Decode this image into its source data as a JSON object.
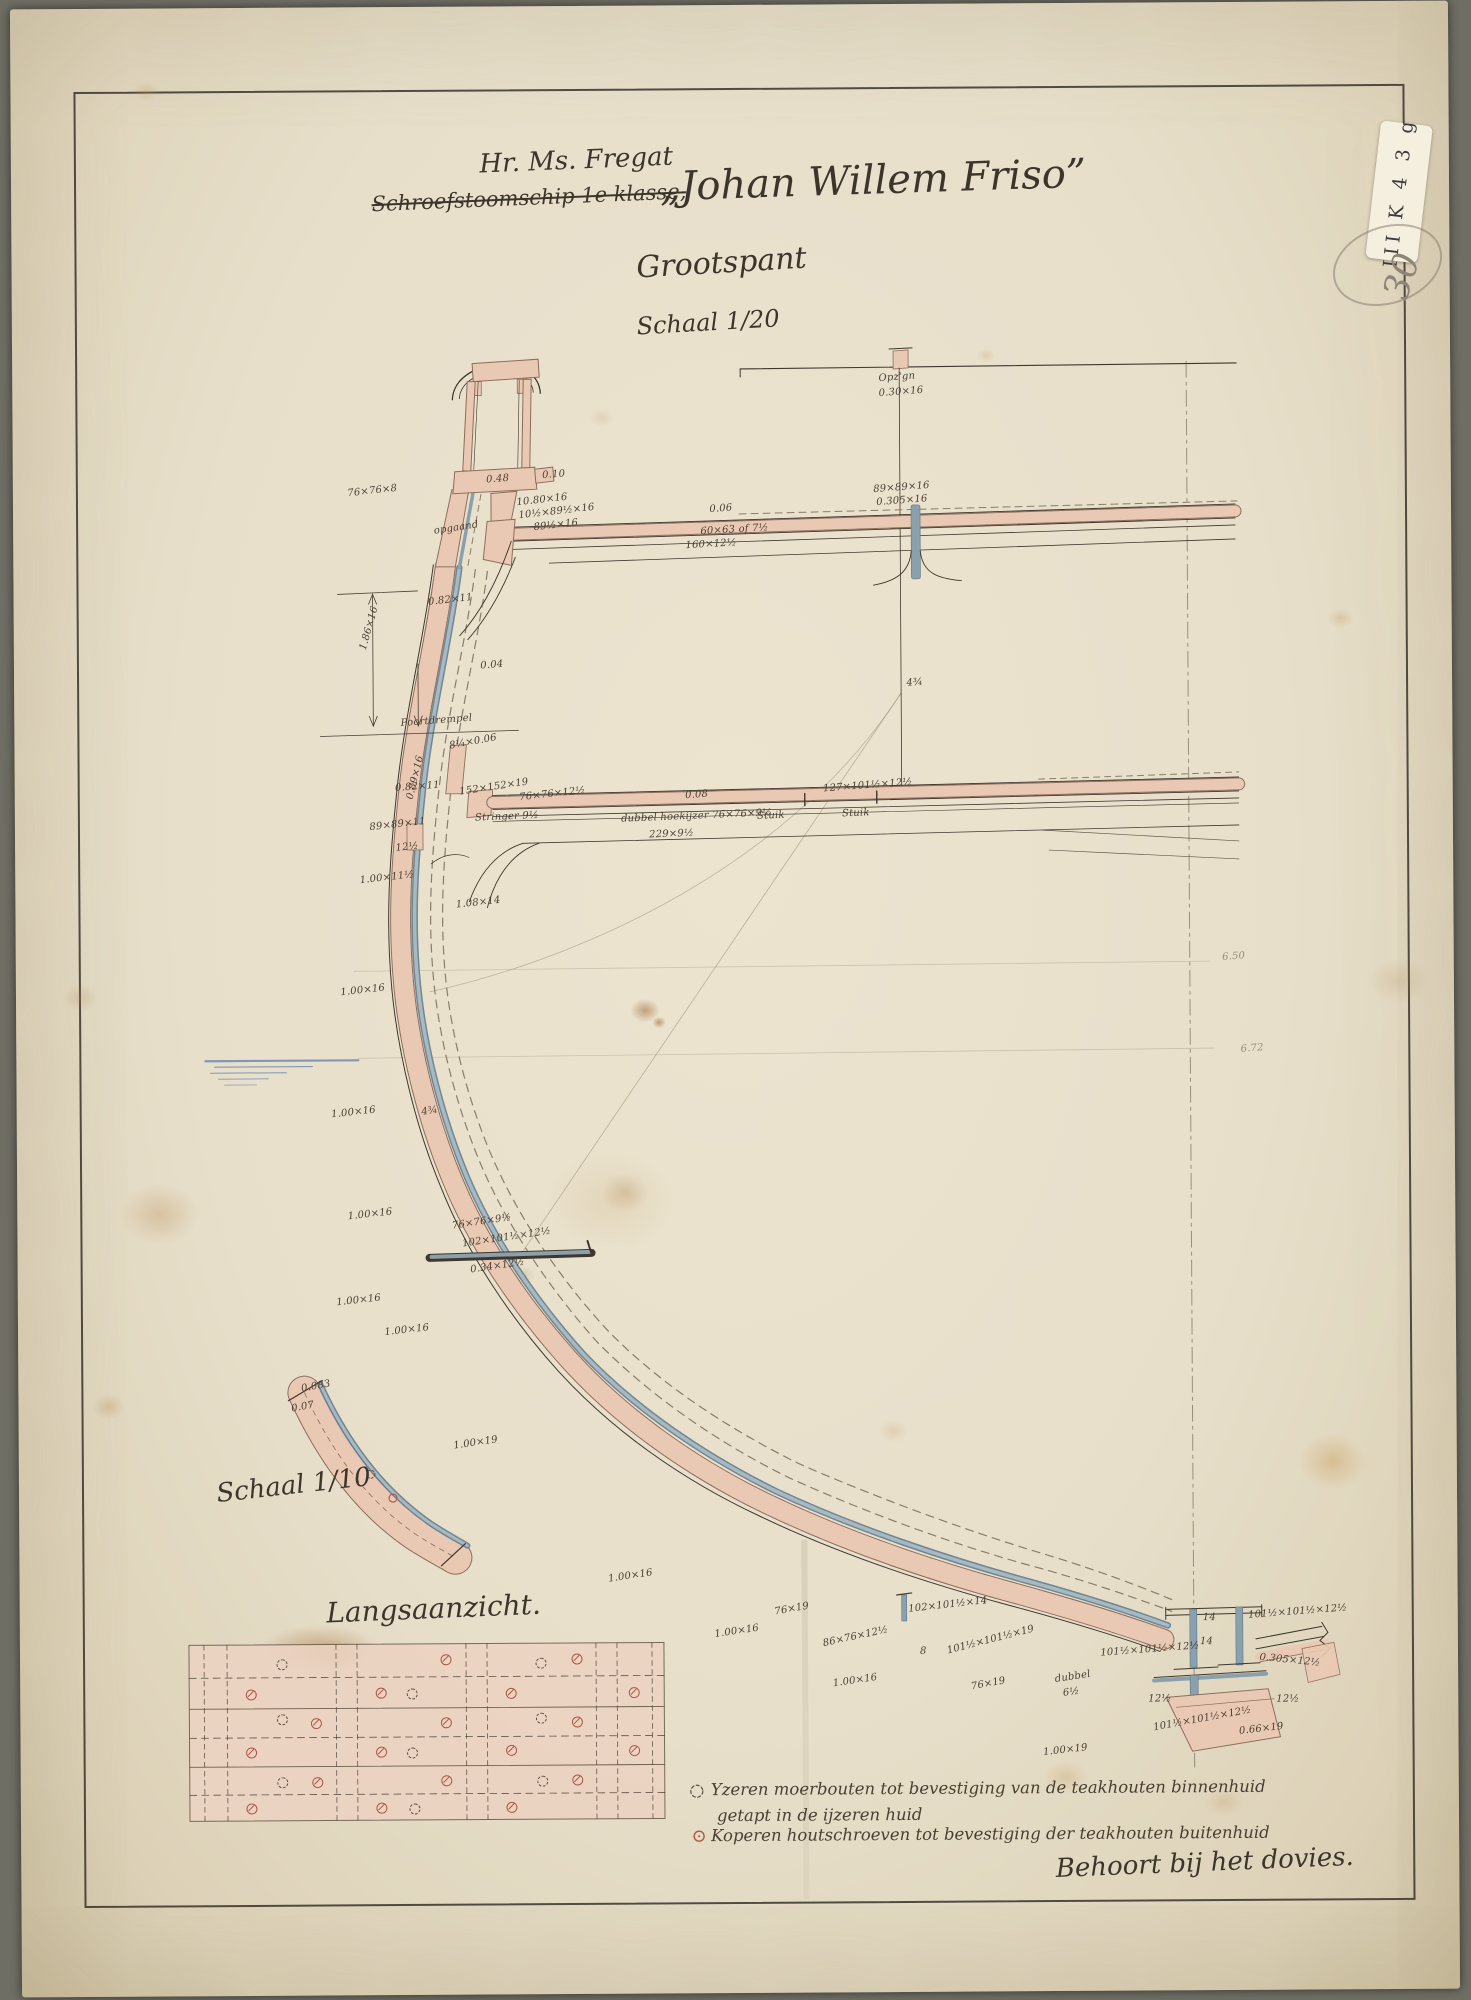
{
  "title": {
    "line1": "Hr. Ms. Fregat",
    "struck": "Schroefstoomschip 1e klasse,",
    "ship_name": "„Johan Willem Friso”",
    "subtitle": "Grootspant",
    "scale_main": "Schaal 1/20"
  },
  "labels": {
    "scale_detail": "Schaal 1/10",
    "side_view": "Langsaanzicht.",
    "note_bottom": "Behoort bij het dovies."
  },
  "stamp": {
    "text": "III K 4 3 g",
    "pencil_number": "30"
  },
  "legend": {
    "items": [
      {
        "symbol": "iron-bolt-symbol",
        "text": "Yzeren moerbouten tot bevestiging van de teakhouten binnenhuid",
        "text2": "getapt in de ijzeren huid"
      },
      {
        "symbol": "copper-screw-symbol",
        "text": "Koperen houtschroeven tot bevestiging der teakhouten buitenhuid",
        "text2": ""
      }
    ]
  },
  "colors": {
    "paper": "#e7dfca",
    "ink": "#3f372c",
    "wood_pink": "#eac9b4",
    "iron_blue": "#8aa0ad",
    "copper_red": "#b05548",
    "pencil": "#8d8578",
    "waterline_blue": "#7f98b5"
  },
  "annotations": [
    {
      "t": "0.48",
      "x": 489,
      "y": 473,
      "r": -4
    },
    {
      "t": "0.10",
      "x": 545,
      "y": 469,
      "r": -4
    },
    {
      "t": "76×76×8",
      "x": 350,
      "y": 486,
      "r": -6
    },
    {
      "t": "10.80×16",
      "x": 519,
      "y": 496,
      "r": -6
    },
    {
      "t": "10½×89½×16",
      "x": 521,
      "y": 509,
      "r": -6
    },
    {
      "t": "89½×16",
      "x": 536,
      "y": 521,
      "r": -6
    },
    {
      "t": "opgaand",
      "x": 436,
      "y": 524,
      "r": -8
    },
    {
      "t": "Opz'gn",
      "x": 882,
      "y": 374,
      "r": -4
    },
    {
      "t": "0.30×16",
      "x": 882,
      "y": 389,
      "r": -4
    },
    {
      "t": "89×89×16",
      "x": 876,
      "y": 485,
      "r": -4
    },
    {
      "t": "0.305×16",
      "x": 879,
      "y": 498,
      "r": -4
    },
    {
      "t": "0.06",
      "x": 712,
      "y": 504,
      "r": -4
    },
    {
      "t": "60×63 of 7½",
      "x": 703,
      "y": 526,
      "r": -3
    },
    {
      "t": "160×12½",
      "x": 688,
      "y": 540,
      "r": -3
    },
    {
      "t": "0.82×11",
      "x": 430,
      "y": 595,
      "r": -6
    },
    {
      "t": "1.86×16",
      "x": 360,
      "y": 646,
      "r": -74
    },
    {
      "t": "0.04",
      "x": 482,
      "y": 659,
      "r": -4
    },
    {
      "t": "Poortdrempel",
      "x": 402,
      "y": 716,
      "r": -4
    },
    {
      "t": "8¼×0.06",
      "x": 450,
      "y": 739,
      "r": -10
    },
    {
      "t": "0.89×16",
      "x": 406,
      "y": 796,
      "r": -76
    },
    {
      "t": "0.82×11",
      "x": 396,
      "y": 781,
      "r": -4
    },
    {
      "t": "89×89×11",
      "x": 370,
      "y": 820,
      "r": -6
    },
    {
      "t": "152×152×19",
      "x": 460,
      "y": 785,
      "r": -8
    },
    {
      "t": "76×76×12½",
      "x": 520,
      "y": 791,
      "r": -6
    },
    {
      "t": "0.08",
      "x": 686,
      "y": 790,
      "r": -4
    },
    {
      "t": "127×101½×12½",
      "x": 824,
      "y": 784,
      "r": -4
    },
    {
      "t": "Stringer 9½",
      "x": 476,
      "y": 811,
      "r": -2
    },
    {
      "t": "dubbel hoekijzer 76×76×9½",
      "x": 622,
      "y": 813,
      "r": -2
    },
    {
      "t": "Stuik",
      "x": 758,
      "y": 811,
      "r": -2
    },
    {
      "t": "Stuik",
      "x": 843,
      "y": 809,
      "r": -2
    },
    {
      "t": "229×9½",
      "x": 650,
      "y": 829,
      "r": -2
    },
    {
      "t": "12½",
      "x": 396,
      "y": 841,
      "r": -6
    },
    {
      "t": "4¾",
      "x": 908,
      "y": 679,
      "r": -4
    },
    {
      "t": "1.00×11½",
      "x": 360,
      "y": 873,
      "r": -6
    },
    {
      "t": "1.08×14",
      "x": 456,
      "y": 898,
      "r": -6
    },
    {
      "t": "1.00×16",
      "x": 340,
      "y": 985,
      "r": -6
    },
    {
      "t": "1.00×16",
      "x": 330,
      "y": 1107,
      "r": -6
    },
    {
      "t": "4¾",
      "x": 420,
      "y": 1105,
      "r": -8
    },
    {
      "t": "1.00×16",
      "x": 346,
      "y": 1209,
      "r": -6
    },
    {
      "t": "76×76×9½",
      "x": 450,
      "y": 1219,
      "r": -8
    },
    {
      "t": "102×101½×12½",
      "x": 460,
      "y": 1237,
      "r": -8
    },
    {
      "t": "0.34×12½",
      "x": 468,
      "y": 1263,
      "r": -8
    },
    {
      "t": "1.00×16",
      "x": 334,
      "y": 1295,
      "r": -6
    },
    {
      "t": "1.00×16",
      "x": 382,
      "y": 1325,
      "r": -6
    },
    {
      "t": "1.00×19",
      "x": 450,
      "y": 1439,
      "r": -8
    },
    {
      "t": "1.00×16",
      "x": 604,
      "y": 1573,
      "r": -8
    },
    {
      "t": "76×19",
      "x": 770,
      "y": 1607,
      "r": -10
    },
    {
      "t": "1.00×16",
      "x": 710,
      "y": 1629,
      "r": -8
    },
    {
      "t": "86×76×12½",
      "x": 818,
      "y": 1639,
      "r": -12
    },
    {
      "t": "8",
      "x": 916,
      "y": 1647,
      "r": 0
    },
    {
      "t": "102×101½×14",
      "x": 904,
      "y": 1605,
      "r": -6
    },
    {
      "t": "101½×101½×19",
      "x": 942,
      "y": 1647,
      "r": -14
    },
    {
      "t": "1.00×16",
      "x": 828,
      "y": 1679,
      "r": -8
    },
    {
      "t": "76×19",
      "x": 966,
      "y": 1683,
      "r": -10
    },
    {
      "t": "1.00×19",
      "x": 1038,
      "y": 1749,
      "r": -6
    },
    {
      "t": "dubbel",
      "x": 1050,
      "y": 1676,
      "r": -8
    },
    {
      "t": "6½",
      "x": 1058,
      "y": 1690,
      "r": -8
    },
    {
      "t": "14",
      "x": 1199,
      "y": 1615,
      "r": 0
    },
    {
      "t": "101½×101½×12½",
      "x": 1244,
      "y": 1613,
      "r": -4
    },
    {
      "t": "14",
      "x": 1196,
      "y": 1639,
      "r": 0
    },
    {
      "t": "101½×101½×12½",
      "x": 1096,
      "y": 1650,
      "r": -4
    },
    {
      "t": "0.305×12½",
      "x": 1256,
      "y": 1655,
      "r": 6
    },
    {
      "t": "12½",
      "x": 1144,
      "y": 1696,
      "r": 0
    },
    {
      "t": "12½",
      "x": 1272,
      "y": 1697,
      "r": 0
    },
    {
      "t": "101½×101½×12½",
      "x": 1148,
      "y": 1725,
      "r": -10
    },
    {
      "t": "0.66×19",
      "x": 1234,
      "y": 1729,
      "r": -6
    },
    {
      "t": "0.083",
      "x": 298,
      "y": 1381,
      "r": -10
    },
    {
      "t": "0.07",
      "x": 288,
      "y": 1401,
      "r": -10
    },
    {
      "t": "6.50",
      "x": 1222,
      "y": 955,
      "r": -4,
      "p": true
    },
    {
      "t": "6.72",
      "x": 1240,
      "y": 1047,
      "r": -4,
      "p": true
    }
  ],
  "langsaanzicht_symbols": [
    {
      "x": 278,
      "y": 1662,
      "t": "i"
    },
    {
      "x": 442,
      "y": 1658,
      "t": "c"
    },
    {
      "x": 537,
      "y": 1662,
      "t": "i"
    },
    {
      "x": 573,
      "y": 1658,
      "t": "c"
    },
    {
      "x": 247,
      "y": 1692,
      "t": "c"
    },
    {
      "x": 377,
      "y": 1691,
      "t": "c"
    },
    {
      "x": 408,
      "y": 1692,
      "t": "i"
    },
    {
      "x": 507,
      "y": 1692,
      "t": "c"
    },
    {
      "x": 630,
      "y": 1692,
      "t": "c"
    },
    {
      "x": 278,
      "y": 1717,
      "t": "i"
    },
    {
      "x": 312,
      "y": 1721,
      "t": "c"
    },
    {
      "x": 442,
      "y": 1721,
      "t": "c"
    },
    {
      "x": 537,
      "y": 1717,
      "t": "i"
    },
    {
      "x": 573,
      "y": 1721,
      "t": "c"
    },
    {
      "x": 247,
      "y": 1750,
      "t": "c"
    },
    {
      "x": 377,
      "y": 1750,
      "t": "c"
    },
    {
      "x": 408,
      "y": 1751,
      "t": "i"
    },
    {
      "x": 507,
      "y": 1749,
      "t": "c"
    },
    {
      "x": 630,
      "y": 1750,
      "t": "c"
    },
    {
      "x": 278,
      "y": 1780,
      "t": "i"
    },
    {
      "x": 313,
      "y": 1780,
      "t": "c"
    },
    {
      "x": 442,
      "y": 1779,
      "t": "c"
    },
    {
      "x": 538,
      "y": 1780,
      "t": "i"
    },
    {
      "x": 573,
      "y": 1779,
      "t": "c"
    },
    {
      "x": 247,
      "y": 1806,
      "t": "c"
    },
    {
      "x": 377,
      "y": 1806,
      "t": "c"
    },
    {
      "x": 410,
      "y": 1807,
      "t": "i"
    },
    {
      "x": 507,
      "y": 1806,
      "t": "c"
    }
  ]
}
